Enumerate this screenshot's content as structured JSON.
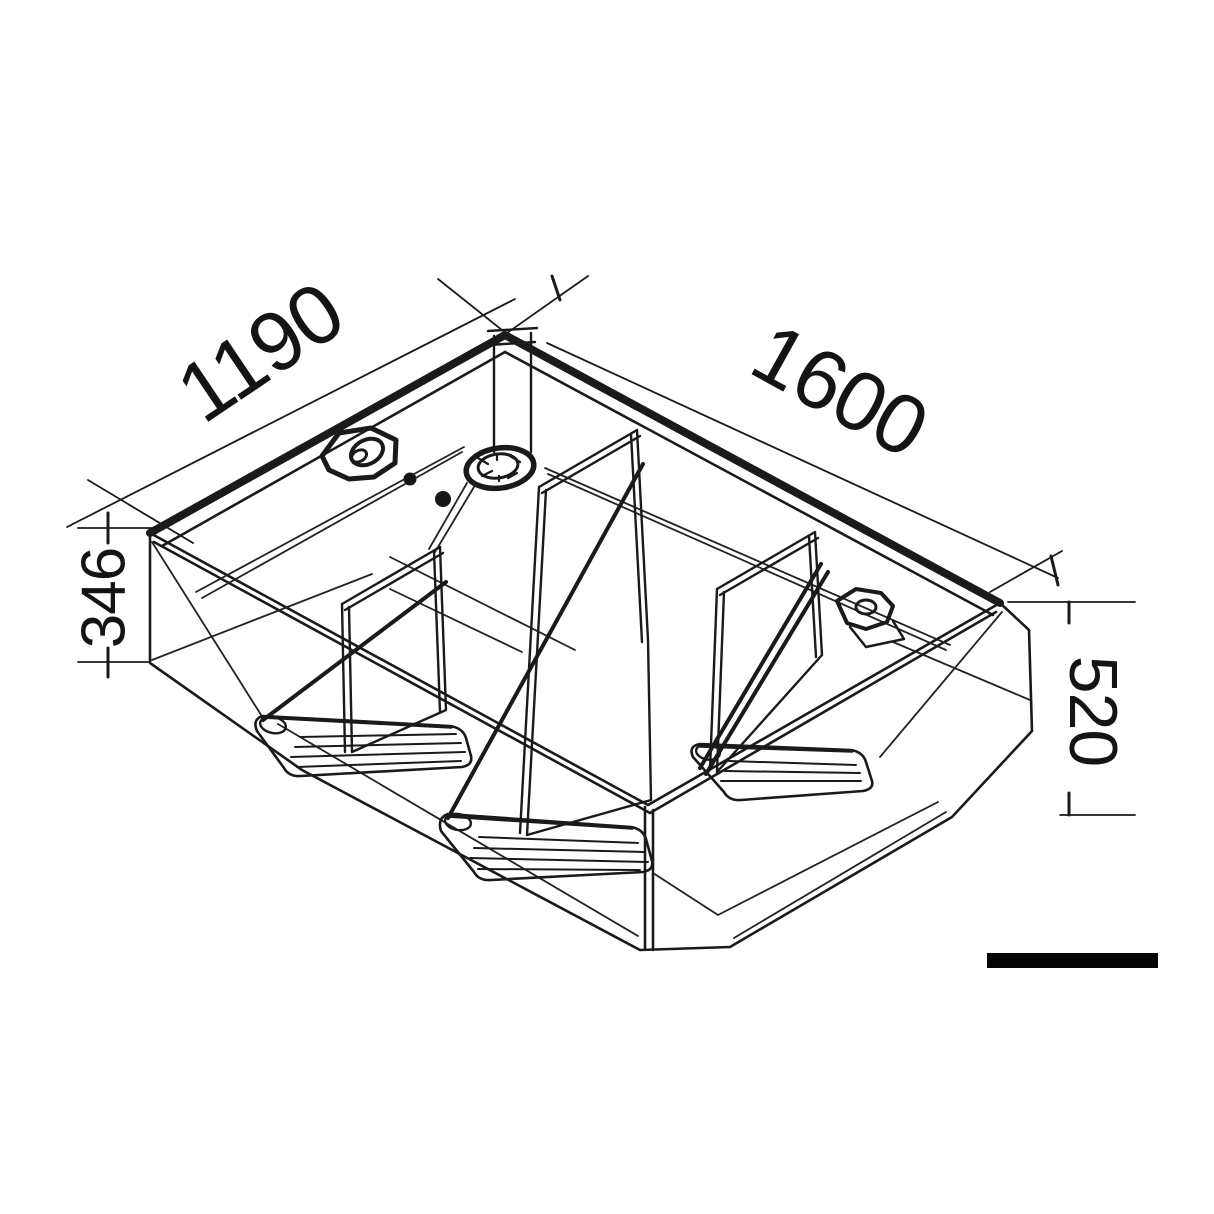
{
  "drawing": {
    "type": "isometric-technical-drawing",
    "subject": "tank-with-internal-baffles",
    "line_color": "#1a1a1a",
    "background": "#ffffff",
    "labels": {
      "depth": "1190",
      "width": "1600",
      "height_left": "346",
      "height_right": "520"
    },
    "features": [
      "filler-cap",
      "inspection-port",
      "standpipe",
      "outlet-fitting",
      "baffle-left",
      "baffle-middle",
      "baffle-right",
      "scale-bar"
    ]
  }
}
